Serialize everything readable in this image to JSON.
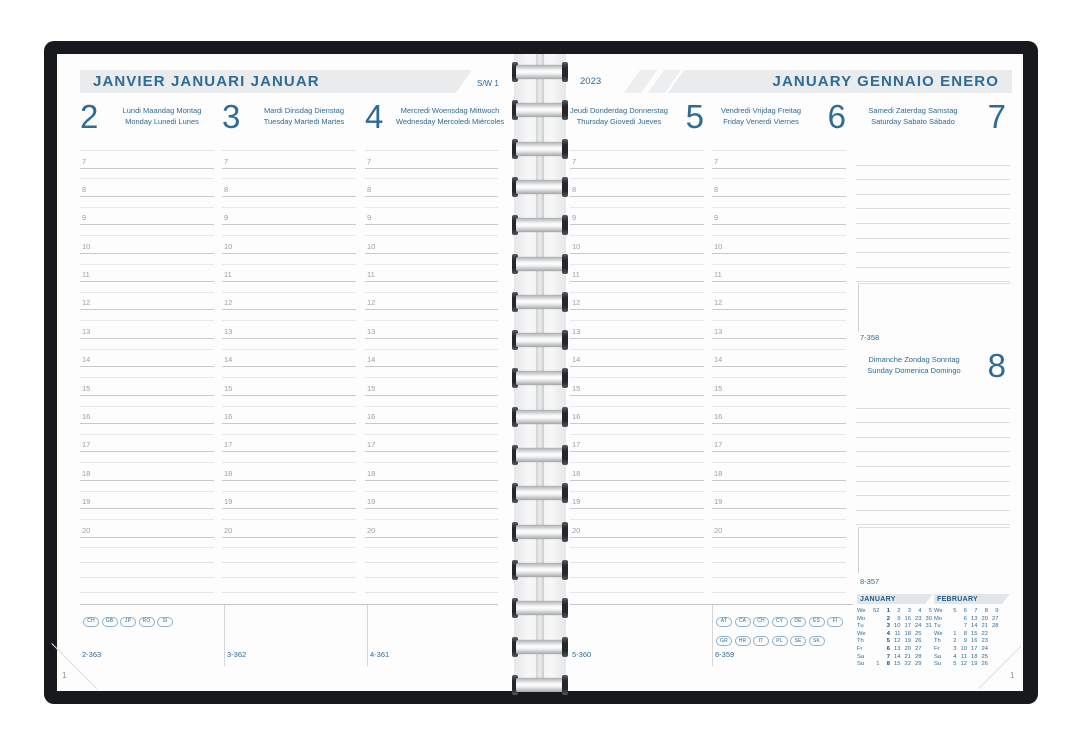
{
  "hours": [
    "7",
    "8",
    "9",
    "10",
    "11",
    "12",
    "13",
    "14",
    "15",
    "16",
    "17",
    "18",
    "19",
    "20"
  ],
  "left_page": {
    "month_title": "JANVIER  JANUARI  JANUAR",
    "week_label": "S/W 1",
    "page_number": "1",
    "days": [
      {
        "number": "2",
        "names_line1": "Lundi  Maandag  Montag",
        "names_line2": "Monday  Lunedi  Lunes",
        "day_code": "2-363",
        "badges": [
          "CH",
          "GB",
          "JP",
          "RO",
          "SI"
        ]
      },
      {
        "number": "3",
        "names_line1": "Mardi  Dinsdag  Dienstag",
        "names_line2": "Tuesday  Martedi  Martes",
        "day_code": "3-362",
        "badges": []
      },
      {
        "number": "4",
        "names_line1": "Mercredi  Woensdag  Mittwoch",
        "names_line2": "Wednesday  Mercoledi  Miércoles",
        "day_code": "4-361",
        "badges": []
      }
    ]
  },
  "right_page": {
    "year": "2023",
    "month_title": "JANUARY  GENNAIO  ENERO",
    "page_number": "1",
    "days": [
      {
        "number": "5",
        "names_line1": "Jeudi  Donderdag  Donnerstag",
        "names_line2": "Thursday  Giovedi  Jueves",
        "day_code": "5-360",
        "badges": []
      },
      {
        "number": "6",
        "names_line1": "Vendredi  Vrijdag  Freitag",
        "names_line2": "Friday  Venerdi  Viernes",
        "day_code": "6-359",
        "badges": [
          "AT",
          "CA",
          "CH",
          "CY",
          "DE",
          "ES",
          "FI",
          "GR",
          "HR",
          "IT",
          "PL",
          "SE",
          "SK"
        ]
      }
    ],
    "saturday": {
      "number": "7",
      "names_line1": "Samedi  Zaterdag  Samstag",
      "names_line2": "Saturday  Sabato  Sábado",
      "day_code": "7-358"
    },
    "sunday": {
      "number": "8",
      "names_line1": "Dimanche  Zondag  Sonntag",
      "names_line2": "Sunday  Domenica  Domingo",
      "day_code": "8-357"
    },
    "mini_calendars": [
      {
        "title": "JANUARY",
        "bold_column": 2,
        "rows": [
          [
            "We",
            "52",
            "1",
            "2",
            "3",
            "4",
            "5"
          ],
          [
            "Mo",
            "",
            "2",
            "9",
            "16",
            "23",
            "30"
          ],
          [
            "Tu",
            "",
            "3",
            "10",
            "17",
            "24",
            "31"
          ],
          [
            "We",
            "",
            "4",
            "11",
            "18",
            "25",
            ""
          ],
          [
            "Th",
            "",
            "5",
            "12",
            "19",
            "26",
            ""
          ],
          [
            "Fr",
            "",
            "6",
            "13",
            "20",
            "27",
            ""
          ],
          [
            "Sa",
            "",
            "7",
            "14",
            "21",
            "28",
            ""
          ],
          [
            "Su",
            "1",
            "8",
            "15",
            "22",
            "29",
            ""
          ]
        ]
      },
      {
        "title": "FEBRUARY",
        "bold_column": -1,
        "rows": [
          [
            "We",
            "5",
            "6",
            "7",
            "8",
            "9",
            ""
          ],
          [
            "Mo",
            "",
            "6",
            "13",
            "20",
            "27",
            ""
          ],
          [
            "Tu",
            "",
            "7",
            "14",
            "21",
            "28",
            ""
          ],
          [
            "We",
            "1",
            "8",
            "15",
            "22",
            "",
            ""
          ],
          [
            "Th",
            "2",
            "9",
            "16",
            "23",
            "",
            ""
          ],
          [
            "Fr",
            "3",
            "10",
            "17",
            "24",
            "",
            ""
          ],
          [
            "Sa",
            "4",
            "11",
            "18",
            "25",
            "",
            ""
          ],
          [
            "Su",
            "5",
            "12",
            "19",
            "26",
            "",
            ""
          ]
        ]
      }
    ]
  },
  "colors": {
    "accent_blue": "#2e6b96",
    "calendar_blue": "#1d5a86",
    "band_gray": "#e9ebed",
    "cover_black": "#17191d"
  }
}
